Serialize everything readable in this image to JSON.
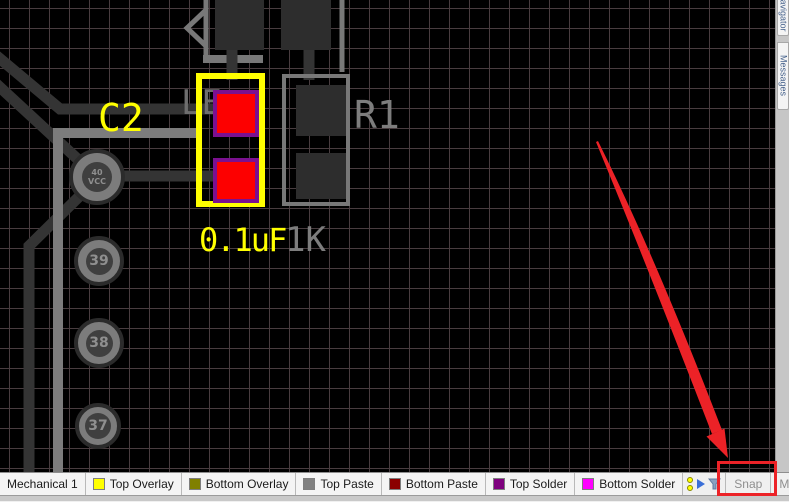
{
  "colors": {
    "board_bg": "#000000",
    "grid_line": "#483c3f",
    "selection_yellow": "#ffff00",
    "pad_red": "#fd0000",
    "pad_red_border": "#7b1090",
    "pad_dark": "#2d2d2d",
    "silkscreen_gray": "#787878",
    "trace_dark": "#343434",
    "trace_light": "#7c7c7c",
    "label_yellow": "#ffff00",
    "label_gray": "#7d7d7d",
    "annotation_red": "#ec2227",
    "bar_bg": "#f0f0f0",
    "bar_text": "#1a1a1a",
    "bar_disabled_text": "#8f8f8f",
    "panel_strip": "#c6c6c6"
  },
  "board": {
    "components": {
      "c2": {
        "designator": "C2",
        "value": "0.1uF"
      },
      "r1": {
        "designator": "R1",
        "value": "1K"
      },
      "hidden_text_fragment": "LE"
    },
    "vias": [
      {
        "label": "40",
        "sublabel": "VCC",
        "x": 97,
        "y": 177,
        "d": 56,
        "inner": 30
      },
      {
        "label": "39",
        "sublabel": "",
        "x": 99,
        "y": 261,
        "d": 50,
        "inner": 27
      },
      {
        "label": "38",
        "sublabel": "",
        "x": 99,
        "y": 343,
        "d": 50,
        "inner": 27
      },
      {
        "label": "37",
        "sublabel": "",
        "x": 98,
        "y": 426,
        "d": 46,
        "inner": 26
      }
    ]
  },
  "right_panel": {
    "tabs": [
      {
        "label": "Navigator"
      },
      {
        "label": "Messages"
      }
    ]
  },
  "status_bar": {
    "layer_tabs": [
      {
        "label": "Mechanical 1",
        "swatch": null
      },
      {
        "label": "Top Overlay",
        "swatch": "#ffff00"
      },
      {
        "label": "Bottom Overlay",
        "swatch": "#808000"
      },
      {
        "label": "Top Paste",
        "swatch": "#808080"
      },
      {
        "label": "Bottom Paste",
        "swatch": "#8b0000"
      },
      {
        "label": "Top Solder",
        "swatch": "#7d007d"
      },
      {
        "label": "Bottom Solder",
        "swatch": "#ff00ff"
      }
    ],
    "buttons": [
      {
        "label": "Snap",
        "enabled": false
      },
      {
        "label": "Mask Level",
        "enabled": false
      },
      {
        "label": "Clear",
        "enabled": true
      }
    ]
  }
}
